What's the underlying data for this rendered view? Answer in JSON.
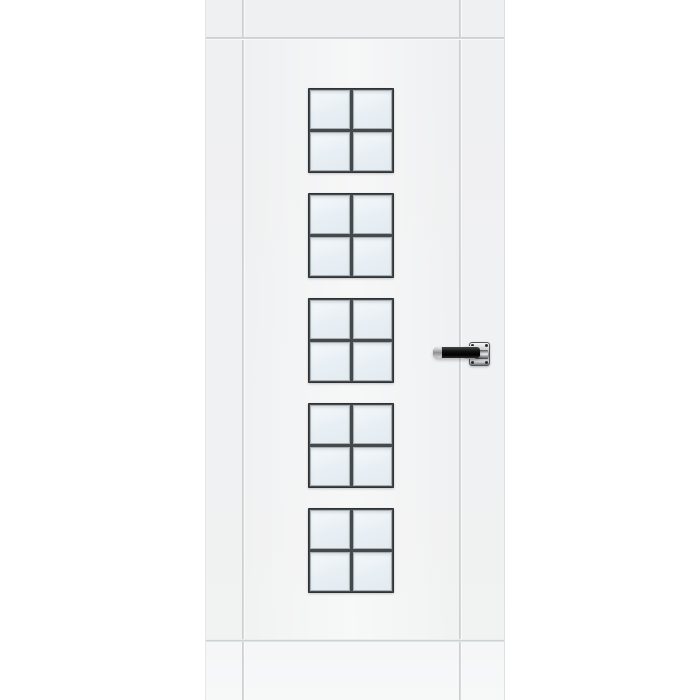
{
  "scene": {
    "type": "product photo",
    "subject": "White interior door leaf with five black-framed four-pane glazing units and a black lever handle, cropped at top and bottom on a white background",
    "background_color": "#ffffff",
    "visible_text": ""
  },
  "door": {
    "finish_color": "#f0f1f2",
    "construction": "stile-and-rail door with full-height recessed grooves on both stiles and horizontal grooves under the top rail and above the bottom rail",
    "groove_shadow_color": "#c5c9cb",
    "groove_highlight_color": "#ffffff",
    "bottom_rail_color": "#f5f6f7",
    "glazing": {
      "unit_count": 5,
      "grid_per_unit": "2 x 2",
      "total_panes": 20,
      "frame_color": "#45494c",
      "frame_bevel_color": "#a9b0b4",
      "glass_tint_light": "#f4f8fa",
      "glass_tint_mid": "#e8eff4",
      "glass_tint_deep": "#e2ebf1"
    },
    "hardware": {
      "type": "lever handle on square rosette",
      "mounted_side": "right stile, mid-height",
      "lever_direction": "pointing left",
      "lever_color": "#141414",
      "lever_tip_finish_color": "#d9d9d9",
      "rosette_finish": "polished chrome",
      "rosette_color": "#cfd2d3",
      "rosette_edge_color": "#53575a",
      "screw_color": "#2c2e30",
      "screw_count": 4
    }
  },
  "layout": {
    "door_left_px": 205,
    "door_width_px": 300,
    "v_groove_left_px": 36,
    "v_groove_right_px": 253,
    "h_groove_top_px": 37,
    "h_groove_bottom_px": 639,
    "window_left_px": 102,
    "window_width_px": 86,
    "window_height_px": 85,
    "window_tops_px": [
      88,
      193,
      298,
      403,
      508
    ],
    "lever_left_px": 227,
    "lever_top_px": 347,
    "collar_left_px": 258,
    "collar_top_px": 346,
    "rosette_left_px": 263,
    "rosette_top_px": 342
  }
}
